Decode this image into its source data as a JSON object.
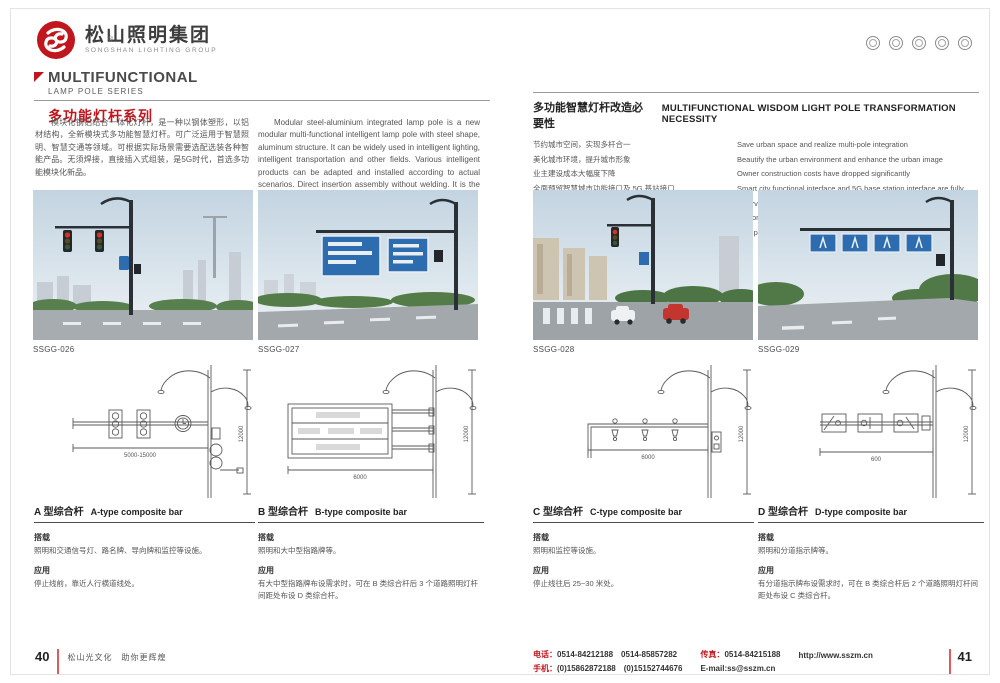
{
  "brand": {
    "name_cn": "松山照明集团",
    "name_en": "SONGSHAN LIGHTING GROUP",
    "reg_mark": "®"
  },
  "colors": {
    "brand_red": "#c0161d",
    "sign_blue": "#2e6cb0",
    "drawing_stroke": "#5a5a5a"
  },
  "labels": {
    "load": "搭载",
    "app": "应用"
  },
  "left_page": {
    "section_title": {
      "en_line1": "MULTIFUNCTIONAL",
      "en_line2": "LAMP POLE SERIES",
      "cn": "多功能灯杆系列"
    },
    "intro_cn": "模块化钢铝结合一体化灯杆，是一种以钢体塑形，以铝材结构，全新模块式多功能智慧灯杆。可广泛运用于智慧照明、智慧交通等领域。可根据实际场景需要选配选装各种智能产品。无须焊接，直接插入式组装，是5G时代，首选多功能模块化新品。",
    "intro_en": "Modular steel-aluminium integrated lamp pole is a new modular multi-functional intelligent lamp pole with steel shape, aluminum structure. It can be widely used in intelligent lighting, intelligent transportation and other fields. Various intelligent products can be adapted and installed according to actual scenarios. Direct insertion assembly without welding. It is the 5G era, the preferred multi-functional modular new products.",
    "photos": [
      {
        "code": "SSGG-026"
      },
      {
        "code": "SSGG-027"
      }
    ],
    "types": [
      {
        "title_cn": "A 型综合杆",
        "title_en": "A-type composite bar",
        "load_text": "照明和交通信号灯、路名牌、导向牌和监控等设施。",
        "app_text": "停止线前，靠近人行横道线处。",
        "dim_h": "5000-15000",
        "dim_v": "12000"
      },
      {
        "title_cn": "B 型综合杆",
        "title_en": "B-type composite bar",
        "load_text": "照明和大中型指路牌等。",
        "app_text": "有大中型指路牌布设需求时，可在 B 类综合杆后 3 个道路照明灯杆间距处布设 D 类综合杆。",
        "dim_h": "6000",
        "dim_v": "12000"
      }
    ],
    "footer": {
      "page_no": "40",
      "tagline": "松山光文化　助你更辉煌"
    }
  },
  "right_page": {
    "necessity": {
      "title_cn": "多功能智慧灯杆改造必要性",
      "title_en": "MULTIFUNCTIONAL WISDOM LIGHT POLE TRANSFORMATION NECESSITY",
      "items": [
        {
          "cn": "节约城市空间，实现多杆合一",
          "en": "Save urban space and realize multi-pole integration"
        },
        {
          "cn": "美化城市环境，提升城市形象",
          "en": "Beautify the urban environment and enhance the urban image"
        },
        {
          "cn": "业主建设成本大幅度下降",
          "en": "Owner construction costs have dropped significantly"
        },
        {
          "cn": "全面预留智慧城市功能接口及 5G 基站接口",
          "en": "Smart city functional interface and 5G base station interface are fully reserved"
        },
        {
          "cn": "一次性管网预留，避免后期重复开挖",
          "en": "The one-time pipe network is reserved to avoid repeated excavation in later period"
        }
      ]
    },
    "photos": [
      {
        "code": "SSGG-028"
      },
      {
        "code": "SSGG-029"
      }
    ],
    "types": [
      {
        "title_cn": "C 型综合杆",
        "title_en": "C-type composite bar",
        "load_text": "照明和监控等设施。",
        "app_text": "停止线往后 25~30 米处。",
        "dim_h": "6000",
        "dim_v": "12000"
      },
      {
        "title_cn": "D 型综合杆",
        "title_en": "D-type composite bar",
        "load_text": "照明和分道指示牌等。",
        "app_text": "有分道指示牌布设需求时，可在 B 类综合杆后 2 个道路照明灯杆间距处布设 C 类综合杆。",
        "dim_h": "600",
        "dim_v": "12000"
      }
    ],
    "footer": {
      "tel_label": "电话：",
      "tel": "0514-84212188　0514-85857282",
      "mobile_label": "手机：",
      "mobile": "(0)15862872188　(0)15152744676",
      "fax_label": "传真：",
      "fax": "0514-84215188",
      "email": "E-mail:ss@sszm.cn",
      "url": "http://www.sszm.cn",
      "page_no": "41"
    }
  }
}
